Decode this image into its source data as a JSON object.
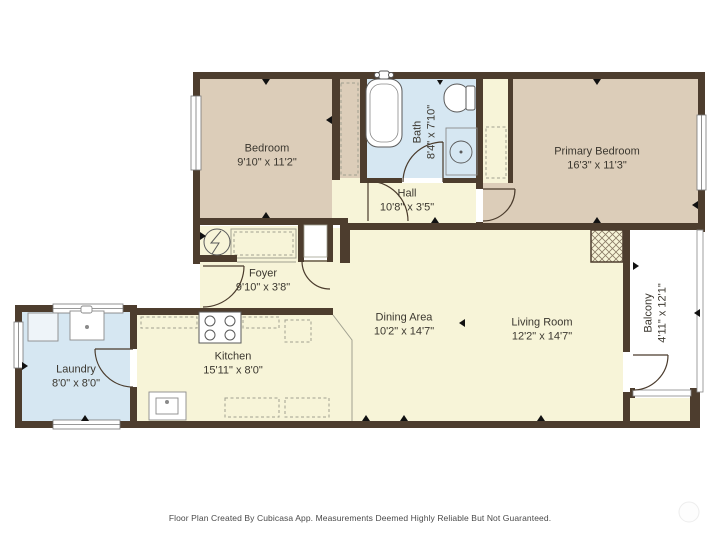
{
  "plan": {
    "rooms": [
      {
        "name": "Bedroom",
        "dims": "9'10\" x 11'2\""
      },
      {
        "name": "Bath",
        "dims": "8'4\" x 7'10\""
      },
      {
        "name": "Primary Bedroom",
        "dims": "16'3\" x 11'3\""
      },
      {
        "name": "Hall",
        "dims": "10'8\" x 3'5\""
      },
      {
        "name": "Foyer",
        "dims": "9'10\" x 3'8\""
      },
      {
        "name": "Laundry",
        "dims": "8'0\" x 8'0\""
      },
      {
        "name": "Kitchen",
        "dims": "15'11\" x 8'0\""
      },
      {
        "name": "Dining Area",
        "dims": "10'2\" x 14'7\""
      },
      {
        "name": "Living Room",
        "dims": "12'2\" x 14'7\""
      },
      {
        "name": "Balcony",
        "dims": "4'11\" x 12'1\""
      }
    ],
    "colors": {
      "wall": "#4d3d2e",
      "bedroom_floor": "#dccdb9",
      "wet_floor": "#d6e7f2",
      "living_floor": "#f7f4d8",
      "balcony_floor": "#ffffff"
    },
    "fixtures": [
      "bathtub",
      "toilet",
      "bathroom-sink",
      "kitchen-stove",
      "kitchen-sink",
      "laundry-sink",
      "washer",
      "water-heater",
      "fireplace-hatch",
      "door-arc",
      "window"
    ]
  },
  "footer": {
    "text": "Floor Plan Created By Cubicasa App. Measurements Deemed Highly Reliable But Not Guaranteed."
  }
}
